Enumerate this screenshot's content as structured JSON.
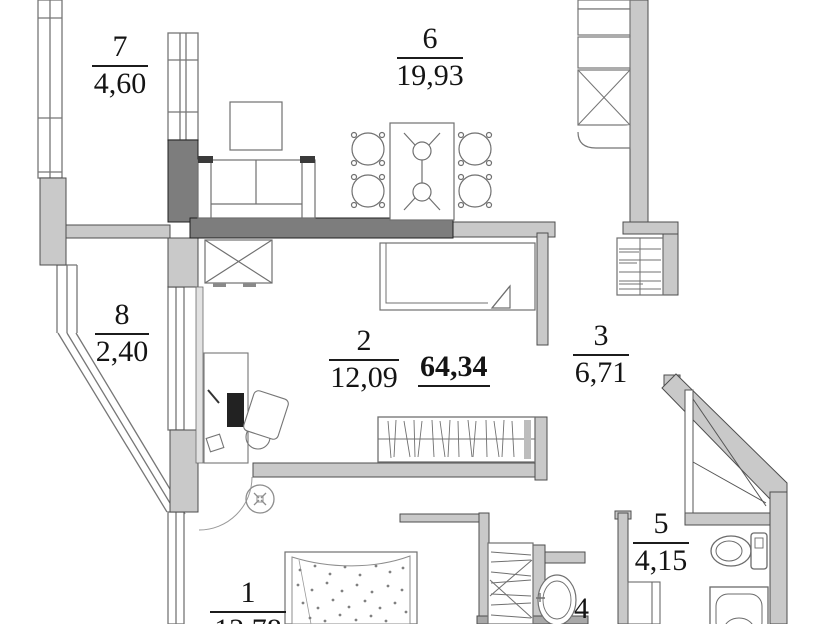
{
  "plan": {
    "title": "apartment-floor-plan",
    "total_area": "64,34",
    "rooms": {
      "r7": {
        "number": "7",
        "area": "4,60"
      },
      "r6": {
        "number": "6",
        "area": "19,93"
      },
      "r8": {
        "number": "8",
        "area": "2,40"
      },
      "r2": {
        "number": "2",
        "area": "12,09"
      },
      "r3": {
        "number": "3",
        "area": "6,71"
      },
      "r5": {
        "number": "5",
        "area": "4,15"
      },
      "r1": {
        "number": "1",
        "area": "12,78"
      },
      "r4": {
        "number": "4",
        "area": ""
      }
    },
    "colors": {
      "wall_light": "#c9c9c9",
      "wall_dark": "#7d7d7d",
      "line": "#4d4d4d",
      "furniture_line": "#707070",
      "background": "#ffffff"
    }
  }
}
